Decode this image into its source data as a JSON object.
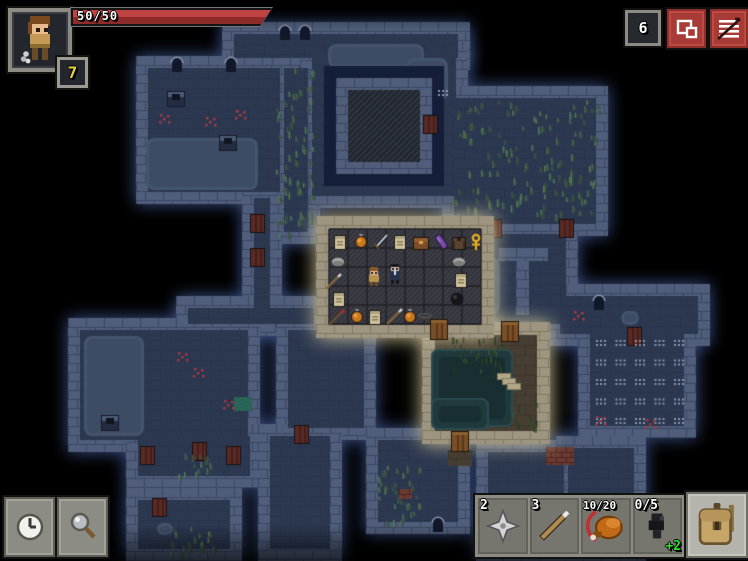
{
  "hud": {
    "health_label": "50/50",
    "level": "7",
    "depth": "6",
    "quickslots": [
      {
        "count": "2",
        "item": "shuriken"
      },
      {
        "count": "3",
        "item": "javelin"
      },
      {
        "count": "10/20",
        "item": "chicken-leg"
      },
      {
        "count": "0/5",
        "item": "dark-totem",
        "bonus": "+2"
      }
    ],
    "icons": {
      "portrait": "hero-sprite",
      "journal": "documents",
      "menu": "menu-lines",
      "wait": "clock",
      "search": "magnifier",
      "backpack": "backpack"
    },
    "colors": {
      "ui_red": "#a93b36",
      "ui_gray": "#8c8c84",
      "health_red": "#b13a3a",
      "bonus_green": "#2ee22e",
      "badge_yellow": "#e8d23e"
    }
  },
  "map": {
    "rooms": [
      {
        "x": 222,
        "y": 22,
        "w": 248,
        "h": 48
      },
      {
        "x": 136,
        "y": 56,
        "w": 156,
        "h": 148
      },
      {
        "x": 272,
        "y": 56,
        "w": 48,
        "h": 188
      },
      {
        "x": 300,
        "y": 42,
        "w": 168,
        "h": 166
      },
      {
        "x": 442,
        "y": 86,
        "w": 166,
        "h": 150
      },
      {
        "x": 478,
        "y": 222,
        "w": 100,
        "h": 114
      },
      {
        "x": 548,
        "y": 284,
        "w": 162,
        "h": 62
      },
      {
        "x": 578,
        "y": 320,
        "w": 118,
        "h": 118
      },
      {
        "x": 242,
        "y": 186,
        "w": 40,
        "h": 148
      },
      {
        "x": 176,
        "y": 296,
        "w": 150,
        "h": 40
      },
      {
        "x": 68,
        "y": 318,
        "w": 192,
        "h": 134
      },
      {
        "x": 276,
        "y": 318,
        "w": 100,
        "h": 122
      },
      {
        "x": 126,
        "y": 424,
        "w": 136,
        "h": 64
      },
      {
        "x": 126,
        "y": 488,
        "w": 116,
        "h": 73
      },
      {
        "x": 258,
        "y": 424,
        "w": 84,
        "h": 137
      },
      {
        "x": 366,
        "y": 428,
        "w": 104,
        "h": 106
      },
      {
        "x": 476,
        "y": 440,
        "w": 100,
        "h": 121
      },
      {
        "x": 556,
        "y": 436,
        "w": 90,
        "h": 125
      }
    ],
    "lit_rooms": [
      {
        "x": 422,
        "y": 322,
        "w": 128,
        "h": 122,
        "k": "brown"
      },
      {
        "x": 316,
        "y": 216,
        "w": 178,
        "h": 122,
        "k": "shop"
      }
    ],
    "features": [
      {
        "t": "water",
        "x": 146,
        "y": 138,
        "w": 112,
        "h": 52
      },
      {
        "t": "water",
        "x": 328,
        "y": 44,
        "w": 96,
        "h": 24
      },
      {
        "t": "water",
        "x": 406,
        "y": 58,
        "w": 42,
        "h": 42
      },
      {
        "t": "navy",
        "x": 324,
        "y": 66,
        "w": 120,
        "h": 120
      },
      {
        "t": "wall",
        "x": 336,
        "y": 78,
        "w": 96,
        "h": 96
      },
      {
        "t": "hatch",
        "x": 348,
        "y": 90,
        "w": 72,
        "h": 72
      },
      {
        "t": "rdoor",
        "x": 424,
        "y": 116
      },
      {
        "t": "dots",
        "x": 434,
        "y": 84,
        "w": 24,
        "h": 22
      },
      {
        "t": "grass",
        "x": 276,
        "y": 66,
        "w": 38,
        "h": 168,
        "n": 70
      },
      {
        "t": "grass",
        "x": 452,
        "y": 100,
        "w": 146,
        "h": 116,
        "n": 150
      },
      {
        "t": "rdoor",
        "x": 488,
        "y": 220
      },
      {
        "t": "rdoor",
        "x": 560,
        "y": 220
      },
      {
        "t": "wall",
        "x": 498,
        "y": 248,
        "w": 50,
        "h": 13
      },
      {
        "t": "wall",
        "x": 516,
        "y": 261,
        "w": 13,
        "h": 54
      },
      {
        "t": "water",
        "x": 484,
        "y": 258,
        "w": 16,
        "h": 56
      },
      {
        "t": "arch",
        "x": 594,
        "y": 296
      },
      {
        "t": "trap",
        "x": 577,
        "y": 315
      },
      {
        "t": "water",
        "x": 621,
        "y": 311,
        "w": 18,
        "h": 14
      },
      {
        "t": "rdoor",
        "x": 628,
        "y": 328
      },
      {
        "t": "dots",
        "x": 592,
        "y": 334,
        "w": 92,
        "h": 90
      },
      {
        "t": "trap",
        "x": 599,
        "y": 420
      },
      {
        "t": "trap",
        "x": 649,
        "y": 423
      },
      {
        "t": "ped",
        "x": 168,
        "y": 92
      },
      {
        "t": "ped",
        "x": 220,
        "y": 136
      },
      {
        "t": "arch",
        "x": 172,
        "y": 58
      },
      {
        "t": "arch",
        "x": 226,
        "y": 58
      },
      {
        "t": "arch",
        "x": 280,
        "y": 26
      },
      {
        "t": "arch",
        "x": 300,
        "y": 26
      },
      {
        "t": "trap",
        "x": 163,
        "y": 118
      },
      {
        "t": "trap",
        "x": 209,
        "y": 121
      },
      {
        "t": "trap",
        "x": 239,
        "y": 114
      },
      {
        "t": "rdoor",
        "x": 251,
        "y": 215
      },
      {
        "t": "rdoor",
        "x": 251,
        "y": 249
      },
      {
        "t": "water",
        "x": 84,
        "y": 336,
        "w": 60,
        "h": 100
      },
      {
        "t": "teal",
        "x": 234,
        "y": 397
      },
      {
        "t": "trap",
        "x": 181,
        "y": 356
      },
      {
        "t": "trap",
        "x": 227,
        "y": 404
      },
      {
        "t": "trap",
        "x": 197,
        "y": 372
      },
      {
        "t": "ped",
        "x": 102,
        "y": 416
      },
      {
        "t": "rdoor",
        "x": 295,
        "y": 426
      },
      {
        "t": "rdoor",
        "x": 141,
        "y": 447
      },
      {
        "t": "rdoor",
        "x": 193,
        "y": 443
      },
      {
        "t": "rdoor",
        "x": 227,
        "y": 447
      },
      {
        "t": "grass",
        "x": 178,
        "y": 452,
        "w": 32,
        "h": 24,
        "n": 14
      },
      {
        "t": "rdoor",
        "x": 153,
        "y": 499
      },
      {
        "t": "water",
        "x": 157,
        "y": 523,
        "w": 16,
        "h": 12
      },
      {
        "t": "grass",
        "x": 170,
        "y": 527,
        "w": 44,
        "h": 26,
        "n": 18
      },
      {
        "t": "grass",
        "x": 378,
        "y": 464,
        "w": 44,
        "h": 58,
        "n": 34
      },
      {
        "t": "arch",
        "x": 433,
        "y": 518
      },
      {
        "t": "rbrick",
        "x": 399,
        "y": 489,
        "w": 13,
        "h": 10
      },
      {
        "t": "rbrick",
        "x": 546,
        "y": 447,
        "w": 28,
        "h": 18
      }
    ],
    "lit_features": [
      {
        "t": "pool",
        "x": 431,
        "y": 349,
        "w": 82,
        "h": 78
      },
      {
        "t": "pool",
        "x": 431,
        "y": 398,
        "w": 58,
        "h": 32
      },
      {
        "t": "dgrass",
        "x": 452,
        "y": 336,
        "w": 50,
        "h": 36,
        "n": 36
      },
      {
        "t": "dgrass",
        "x": 506,
        "y": 402,
        "w": 32,
        "h": 28,
        "n": 16
      },
      {
        "t": "steps",
        "x": 498,
        "y": 374
      },
      {
        "t": "bpatch",
        "x": 448,
        "y": 450,
        "w": 24,
        "h": 16
      },
      {
        "t": "door",
        "x": 431,
        "y": 320
      },
      {
        "t": "door",
        "x": 502,
        "y": 322
      },
      {
        "t": "door",
        "x": 452,
        "y": 432
      }
    ],
    "shop_items": [
      {
        "x": 340,
        "y": 243,
        "t": "scroll"
      },
      {
        "x": 361,
        "y": 243,
        "t": "potion"
      },
      {
        "x": 381,
        "y": 242,
        "t": "sword"
      },
      {
        "x": 400,
        "y": 243,
        "t": "scroll"
      },
      {
        "x": 421,
        "y": 243,
        "t": "chest"
      },
      {
        "x": 441,
        "y": 242,
        "t": "cloak"
      },
      {
        "x": 459,
        "y": 243,
        "t": "armor"
      },
      {
        "x": 476,
        "y": 242,
        "t": "ankh"
      },
      {
        "x": 338,
        "y": 262,
        "t": "stone"
      },
      {
        "x": 459,
        "y": 262,
        "t": "stone"
      },
      {
        "x": 333,
        "y": 282,
        "t": "spear"
      },
      {
        "x": 461,
        "y": 281,
        "t": "scroll"
      },
      {
        "x": 339,
        "y": 300,
        "t": "scroll"
      },
      {
        "x": 457,
        "y": 299,
        "t": "bomb"
      },
      {
        "x": 336,
        "y": 318,
        "t": "rspear"
      },
      {
        "x": 357,
        "y": 318,
        "t": "potion"
      },
      {
        "x": 375,
        "y": 318,
        "t": "scroll"
      },
      {
        "x": 394,
        "y": 317,
        "t": "spear"
      },
      {
        "x": 410,
        "y": 318,
        "t": "potion"
      },
      {
        "x": 425,
        "y": 316,
        "t": "bowl"
      }
    ],
    "sprites": [
      {
        "x": 374,
        "y": 276,
        "t": "hero"
      },
      {
        "x": 395,
        "y": 274,
        "t": "keeper"
      }
    ]
  }
}
